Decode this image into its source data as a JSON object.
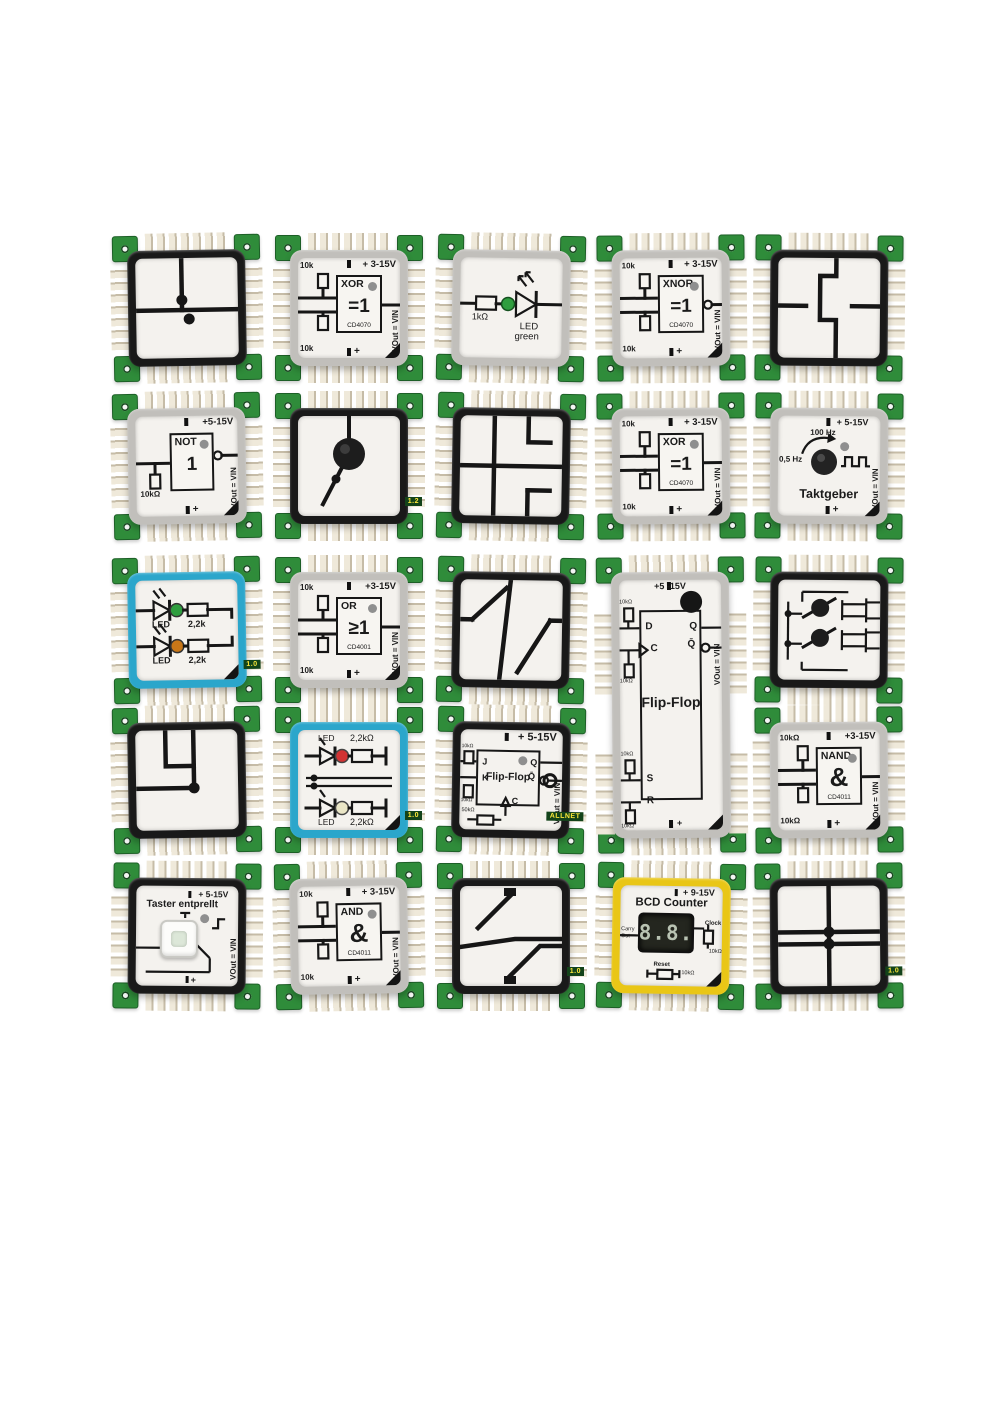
{
  "scene": {
    "background": "#ffffff",
    "frame_colors": {
      "black": "#191919",
      "gray": "#c1bfbb",
      "blue": "#2ba6cb",
      "yellow": "#e9c616"
    },
    "pcb_green": "#2f8c3a"
  },
  "bricks": [
    {
      "id": "junction-cross",
      "kind": "trace",
      "pattern": "crossT",
      "frame": "black",
      "x": 128,
      "y": 250,
      "w": 118,
      "h": 116,
      "labels": {}
    },
    {
      "id": "xor-gate-1",
      "kind": "gate",
      "frame": "gray",
      "x": 290,
      "y": 250,
      "w": 118,
      "h": 116,
      "labels": {
        "v": "+ 3-15V",
        "name": "XOR",
        "sym": "=1",
        "chip": "CD4070",
        "r1": "10k",
        "r2": "10k",
        "vout": "VOut = VIN",
        "plus": "+"
      }
    },
    {
      "id": "led-green",
      "kind": "led1",
      "frame": "gray",
      "x": 452,
      "y": 250,
      "w": 118,
      "h": 116,
      "led": [
        "#2f9e3f"
      ],
      "labels": {
        "r": "1kΩ",
        "l1": "LED",
        "l2": "green"
      }
    },
    {
      "id": "xnor-gate",
      "kind": "gate",
      "bubble": true,
      "frame": "gray",
      "x": 612,
      "y": 250,
      "w": 118,
      "h": 116,
      "labels": {
        "v": "+ 3-15V",
        "name": "XNOR",
        "sym": "=1",
        "chip": "CD4070",
        "r1": "10k",
        "r2": "10k",
        "vout": "VOut = VIN",
        "plus": "+"
      }
    },
    {
      "id": "trace-steps",
      "kind": "trace",
      "pattern": "steps",
      "frame": "black",
      "x": 770,
      "y": 250,
      "w": 118,
      "h": 116,
      "labels": {}
    },
    {
      "id": "not-gate",
      "kind": "gate",
      "single": true,
      "bubble": true,
      "frame": "gray",
      "x": 128,
      "y": 408,
      "w": 118,
      "h": 116,
      "labels": {
        "v": "+5-15V",
        "name": "NOT",
        "sym": "1",
        "r1": "10kΩ",
        "vout": "VOut = VIN",
        "plus": "+"
      }
    },
    {
      "id": "toggle-switch",
      "kind": "switch",
      "frame": "black",
      "x": 290,
      "y": 408,
      "w": 118,
      "h": 116,
      "labels": {
        "edge": "1.2"
      }
    },
    {
      "id": "trace-grid",
      "kind": "trace",
      "pattern": "grid",
      "frame": "black",
      "x": 452,
      "y": 408,
      "w": 118,
      "h": 116,
      "labels": {}
    },
    {
      "id": "xor-gate-2",
      "kind": "gate",
      "frame": "gray",
      "x": 612,
      "y": 408,
      "w": 118,
      "h": 116,
      "labels": {
        "v": "+ 3-15V",
        "name": "XOR",
        "sym": "=1",
        "chip": "CD4070",
        "r1": "10k",
        "r2": "10k",
        "vout": "VOut = VIN",
        "plus": "+"
      }
    },
    {
      "id": "clock-generator",
      "kind": "clock",
      "frame": "gray",
      "x": 770,
      "y": 408,
      "w": 118,
      "h": 116,
      "labels": {
        "v": "+ 5-15V",
        "fhigh": "100 Hz",
        "flow": "0,5 Hz",
        "title": "Taktgeber",
        "vout": "VOut = VIN",
        "plus": "+"
      }
    },
    {
      "id": "led-dual-green-orange",
      "kind": "led2a",
      "frame": "blue",
      "x": 128,
      "y": 572,
      "w": 118,
      "h": 116,
      "led": [
        "#2f9e3f",
        "#c87718"
      ],
      "labels": {
        "l1": "LED",
        "r1": "2,2k",
        "l2": "LED",
        "r2": "2,2k",
        "edge": "1.0"
      }
    },
    {
      "id": "or-gate",
      "kind": "gate",
      "frame": "gray",
      "x": 290,
      "y": 572,
      "w": 118,
      "h": 116,
      "labels": {
        "v": "+3-15V",
        "name": "OR",
        "sym": "≥1",
        "chip": "CD4001",
        "r1": "10k",
        "r2": "10k",
        "vout": "VOut = VIN",
        "plus": "+"
      }
    },
    {
      "id": "trace-diagonal",
      "kind": "trace",
      "pattern": "diag",
      "frame": "black",
      "x": 452,
      "y": 572,
      "w": 118,
      "h": 116,
      "labels": {}
    },
    {
      "id": "d-flipflop",
      "kind": "ffd",
      "frame": "gray",
      "x": 612,
      "y": 572,
      "w": 118,
      "h": 266,
      "labels": {
        "v": "+5 -15V",
        "title": "Flip-Flop",
        "d": "D",
        "c": "C",
        "s": "S",
        "r": "R",
        "q": "Q",
        "qb": "Q̄",
        "res": "10kΩ",
        "vout": "VOut = VIN",
        "plus": "+"
      }
    },
    {
      "id": "dual-switch",
      "kind": "sw2",
      "frame": "black",
      "x": 770,
      "y": 572,
      "w": 118,
      "h": 116,
      "labels": {}
    },
    {
      "id": "trace-corners",
      "kind": "trace",
      "pattern": "corners",
      "frame": "black",
      "x": 128,
      "y": 722,
      "w": 118,
      "h": 116,
      "labels": {}
    },
    {
      "id": "led-dual-red-white",
      "kind": "led2b",
      "frame": "blue",
      "x": 290,
      "y": 722,
      "w": 118,
      "h": 116,
      "led": [
        "#d23333",
        "#eae6c6"
      ],
      "labels": {
        "l1": "LED",
        "r1": "2,2kΩ",
        "l2": "LED",
        "r2": "2,2kΩ",
        "edge": "1.0"
      }
    },
    {
      "id": "jk-flipflop",
      "kind": "ffjk",
      "frame": "black",
      "x": 452,
      "y": 722,
      "w": 118,
      "h": 116,
      "labels": {
        "v": "+ 5-15V",
        "title": "Flip-Flop",
        "j": "J",
        "k": "K",
        "q": "Q",
        "qb": "Q̄",
        "c": "C",
        "r50": "50kΩ",
        "res": "10kΩ",
        "vout": "VOut = VIN",
        "edge": "ALLNET"
      }
    },
    {
      "id": "nand-gate",
      "kind": "gate",
      "frame": "gray",
      "x": 770,
      "y": 722,
      "w": 118,
      "h": 116,
      "labels": {
        "v": "+3-15V",
        "name": "NAND",
        "sym": "&",
        "chip": "CD4011",
        "r1": "10kΩ",
        "r2": "10kΩ",
        "vout": "VOut = VIN",
        "plus": "+"
      }
    },
    {
      "id": "debounced-button",
      "kind": "button",
      "frame": "black",
      "x": 128,
      "y": 878,
      "w": 118,
      "h": 116,
      "labels": {
        "v": "+ 5-15V",
        "title": "Taster entprellt",
        "vout": "VOut = VIN",
        "plus": "+"
      }
    },
    {
      "id": "and-gate",
      "kind": "gate",
      "frame": "gray",
      "x": 290,
      "y": 878,
      "w": 118,
      "h": 116,
      "labels": {
        "v": "+ 3-15V",
        "name": "AND",
        "sym": "&",
        "chip": "CD4011",
        "r1": "10k",
        "r2": "10k",
        "vout": "VOut = VIN",
        "plus": "+"
      }
    },
    {
      "id": "trace-diagonal-2",
      "kind": "trace",
      "pattern": "diag2",
      "frame": "black",
      "x": 452,
      "y": 878,
      "w": 118,
      "h": 116,
      "labels": {
        "edge": "1.0"
      }
    },
    {
      "id": "bcd-counter",
      "kind": "bcd",
      "frame": "yellow",
      "x": 612,
      "y": 878,
      "w": 118,
      "h": 116,
      "labels": {
        "v": "+ 9-15V",
        "title": "BCD Counter",
        "digits": "8.8.",
        "clock": "Clock",
        "rclock": "10kΩ",
        "carry1": "Carry",
        "carry2": "Out",
        "reset": "Reset",
        "rreset": "10kΩ"
      }
    },
    {
      "id": "trace-cross-2",
      "kind": "trace",
      "pattern": "cross2",
      "frame": "black",
      "x": 770,
      "y": 878,
      "w": 118,
      "h": 116,
      "labels": {
        "edge": "1.0"
      }
    }
  ]
}
